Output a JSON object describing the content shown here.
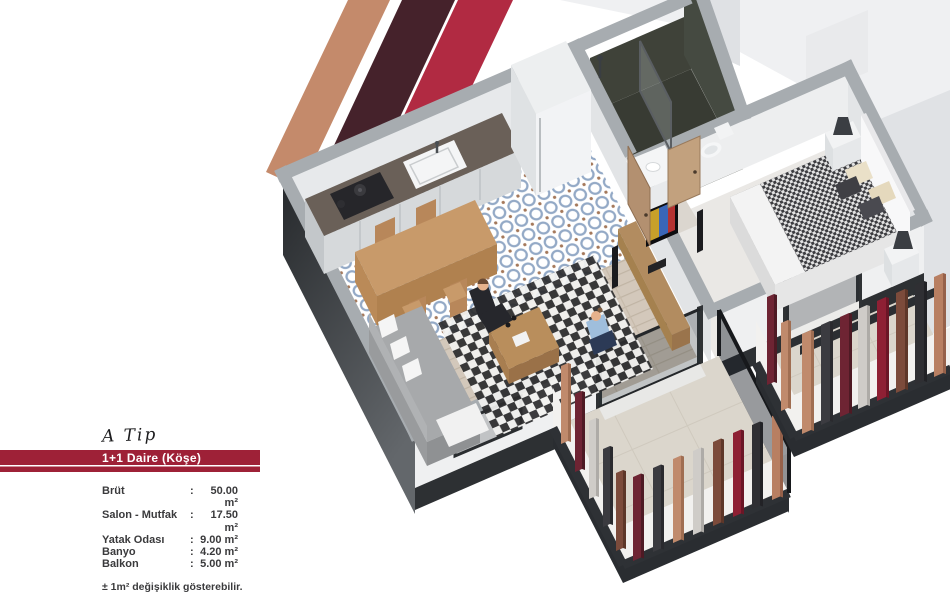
{
  "panel": {
    "type_label": "A Tip",
    "banner_label": "1+1 Daire (Köşe)",
    "rows": [
      {
        "label": "Brüt",
        "colon": ":",
        "value": "50.00 m²"
      },
      {
        "label": "Salon - Mutfak",
        "colon": ":",
        "value": "17.50 m²"
      },
      {
        "label": "Yatak Odası",
        "colon": ":",
        "value": "9.00 m²"
      },
      {
        "label": "Banyo",
        "colon": ":",
        "value": "4.20 m²"
      },
      {
        "label": "Balkon",
        "colon": ":",
        "value": "5.00 m²"
      }
    ],
    "note": "± 1m² değişiklik gösterebilir."
  },
  "colors": {
    "banner_red": "#9E2137",
    "stripe_tan": "#C48A6B",
    "stripe_maroon": "#45222B",
    "stripe_crimson": "#B12A42"
  }
}
